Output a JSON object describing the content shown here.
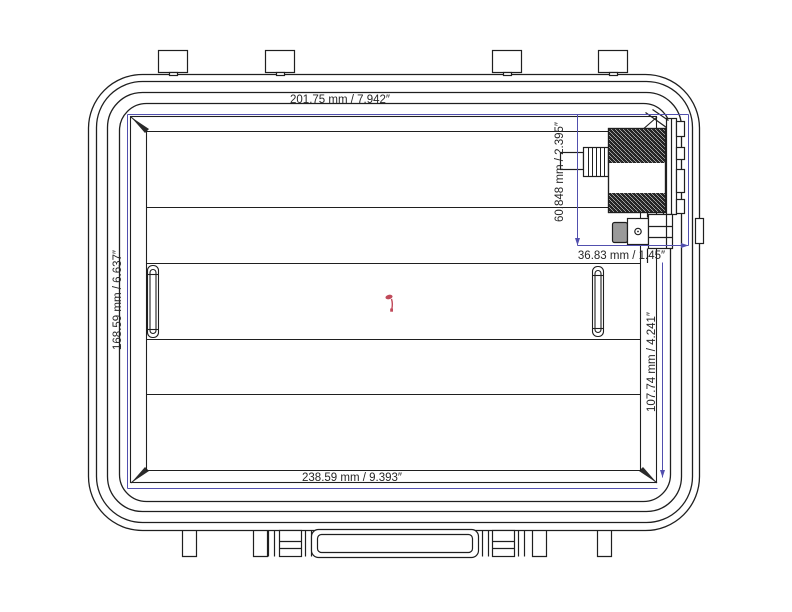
{
  "drawing": {
    "type": "technical-drawing",
    "subject": "waterproof case lid interior with purge valve, top view"
  },
  "dimensions": {
    "top_width": "201.75 mm / 7.942″",
    "left_height": "168.59 mm / 6.637″",
    "bottom_width": "238.59 mm / 9.393″",
    "valve_height": "60.848 mm / 2.395″",
    "valve_offset": "36.83 mm / 1.45″",
    "right_height": "107.74 mm / 4.241″"
  },
  "colors": {
    "line": "#1f1f1f",
    "dimension_line": "#514fae",
    "annotation_mark": "#c04a5a",
    "background": "#ffffff"
  }
}
